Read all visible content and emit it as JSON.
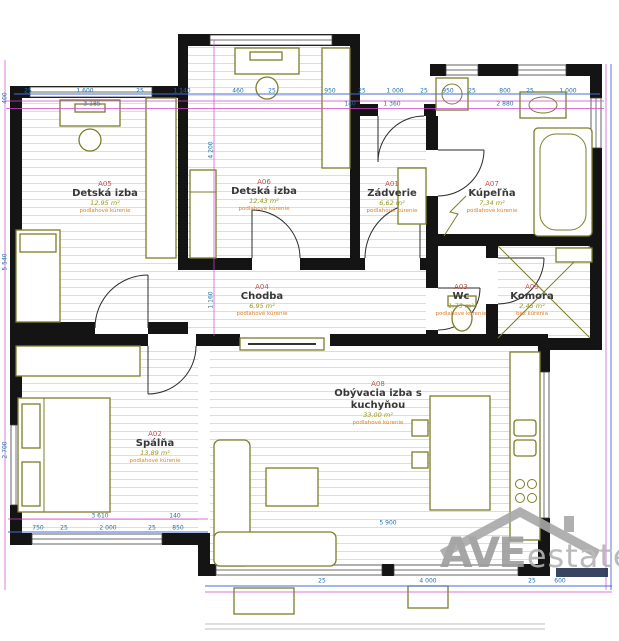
{
  "plan_title": "apartment-floor-plan",
  "rooms": [
    {
      "code": "A05",
      "name": "Detská izba",
      "area": "12,95 m²",
      "note": "podlahové kúrenie",
      "cx": 105,
      "cy": 180
    },
    {
      "code": "A06",
      "name": "Detská izba",
      "area": "12,43 m²",
      "note": "podlahové kúrenie",
      "cx": 264,
      "cy": 178
    },
    {
      "code": "A01",
      "name": "Zádverie",
      "area": "6,62 m²",
      "note": "podlahové kúrenie",
      "cx": 392,
      "cy": 180
    },
    {
      "code": "A07",
      "name": "Kúpeľňa",
      "area": "7,34 m²",
      "note": "podlahové kúrenie",
      "cx": 492,
      "cy": 180
    },
    {
      "code": "A04",
      "name": "Chodba",
      "area": "6,95 m²",
      "note": "podlahové kúrenie",
      "cx": 262,
      "cy": 283
    },
    {
      "code": "A03",
      "name": "Wc",
      "area": "1,75 m²",
      "note": "podlahové kúrenie",
      "cx": 461,
      "cy": 283
    },
    {
      "code": "A09",
      "name": "Komora",
      "area": "2,45 m²",
      "note": "bez kúrenia",
      "cx": 532,
      "cy": 283
    },
    {
      "code": "A02",
      "name": "Spálňa",
      "area": "13,89 m²",
      "note": "podlahové kúrenie",
      "cx": 155,
      "cy": 430
    },
    {
      "code": "A08",
      "name": "Obývacia izba s kuchyňou",
      "area": "33,00 m²",
      "note": "podlahové kúrenie",
      "cx": 378,
      "cy": 380
    }
  ],
  "dimensions": [
    {
      "t": "25",
      "x": 28,
      "y": 91
    },
    {
      "t": "1 600",
      "x": 85,
      "y": 91
    },
    {
      "t": "25",
      "x": 140,
      "y": 91
    },
    {
      "t": "1 140",
      "x": 182,
      "y": 91
    },
    {
      "t": "460",
      "x": 238,
      "y": 91
    },
    {
      "t": "25",
      "x": 272,
      "y": 91
    },
    {
      "t": "950",
      "x": 330,
      "y": 91
    },
    {
      "t": "25",
      "x": 362,
      "y": 91
    },
    {
      "t": "1 000",
      "x": 395,
      "y": 91
    },
    {
      "t": "25",
      "x": 424,
      "y": 91
    },
    {
      "t": "950",
      "x": 448,
      "y": 91
    },
    {
      "t": "25",
      "x": 472,
      "y": 91
    },
    {
      "t": "800",
      "x": 505,
      "y": 91
    },
    {
      "t": "25",
      "x": 530,
      "y": 91
    },
    {
      "t": "1 000",
      "x": 568,
      "y": 91
    },
    {
      "t": "3 185",
      "x": 92,
      "y": 104
    },
    {
      "t": "140",
      "x": 350,
      "y": 104
    },
    {
      "t": "1 360",
      "x": 392,
      "y": 104
    },
    {
      "t": "2 880",
      "x": 505,
      "y": 104
    },
    {
      "t": "400",
      "x": 5,
      "y": 98,
      "r": 1
    },
    {
      "t": "5 540",
      "x": 5,
      "y": 262,
      "r": 1
    },
    {
      "t": "2 700",
      "x": 5,
      "y": 450,
      "r": 1
    },
    {
      "t": "4 200",
      "x": 211,
      "y": 150,
      "r": 1
    },
    {
      "t": "1 160",
      "x": 211,
      "y": 300,
      "r": 1
    },
    {
      "t": "3 610",
      "x": 100,
      "y": 516
    },
    {
      "t": "140",
      "x": 175,
      "y": 516
    },
    {
      "t": "750",
      "x": 38,
      "y": 528
    },
    {
      "t": "25",
      "x": 64,
      "y": 528
    },
    {
      "t": "2 000",
      "x": 108,
      "y": 528
    },
    {
      "t": "25",
      "x": 152,
      "y": 528
    },
    {
      "t": "850",
      "x": 178,
      "y": 528
    },
    {
      "t": "5 900",
      "x": 388,
      "y": 523
    },
    {
      "t": "25",
      "x": 322,
      "y": 581
    },
    {
      "t": "4 000",
      "x": 428,
      "y": 581
    },
    {
      "t": "25",
      "x": 532,
      "y": 581
    },
    {
      "t": "600",
      "x": 560,
      "y": 581
    }
  ],
  "logo": {
    "part1": "AVE",
    "part2": "estate"
  },
  "colors": {
    "wall": "#141414",
    "furniture": "#7d7d2a",
    "dimension_line_magenta": "#cf46cf",
    "dimension_line_blue": "#4a6bd4",
    "dimension_number": "#1f6fa8",
    "room_code": "#c0504d",
    "room_name": "#383838",
    "room_area": "#98981f",
    "heating_note": "#e0812a",
    "logo_gray": "#9d9d9d",
    "logo_bar": "#25304f"
  }
}
